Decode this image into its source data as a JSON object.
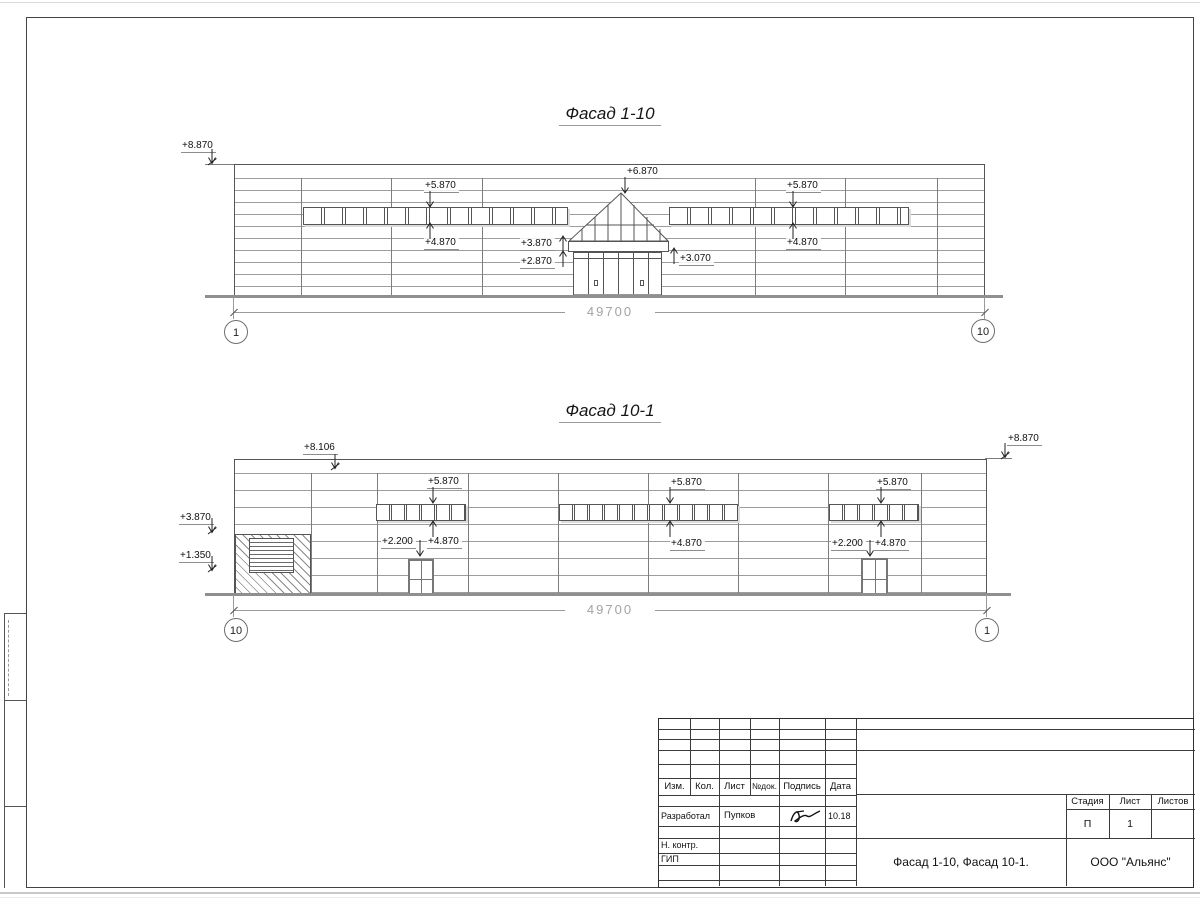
{
  "f1": {
    "title": "Фасад 1-10",
    "labels": [
      "+8.870",
      "+5.870",
      "+4.870",
      "+6.870",
      "+3.870",
      "+2.870",
      "+3.070",
      "+5.870",
      "+4.870"
    ],
    "dim": "49700",
    "axes": [
      "1",
      "10"
    ]
  },
  "f2": {
    "title": "Фасад 10-1",
    "labels": [
      "+8.106",
      "+8.870",
      "+3.870",
      "+1.350",
      "+5.870",
      "+4.870",
      "+2.200",
      "+5.870",
      "+4.870",
      "+5.870",
      "+4.870",
      "+2.200"
    ],
    "dim": "49700",
    "axes": [
      "10",
      "1"
    ]
  },
  "titleblock": {
    "cols": [
      "Изм.",
      "Кол.",
      "Лист",
      "№док.",
      "Подпись",
      "Дата"
    ],
    "developed_label": "Разработал",
    "developed_name": "Пупков",
    "developed_date": "10.18",
    "ncontr_label": "Н. контр.",
    "gip_label": "ГИП",
    "doc_title": "Фасад 1-10, Фасад 10-1.",
    "org": "ООО \"Альянс\"",
    "stage_label": "Стадия",
    "sheet_label": "Лист",
    "sheets_label": "Листов",
    "stage": "П",
    "sheet_no": "1",
    "sheets_total": ""
  },
  "colors": {
    "line": "#555555",
    "dim": "#a3a3a3",
    "ground": "#8f8f8f"
  }
}
